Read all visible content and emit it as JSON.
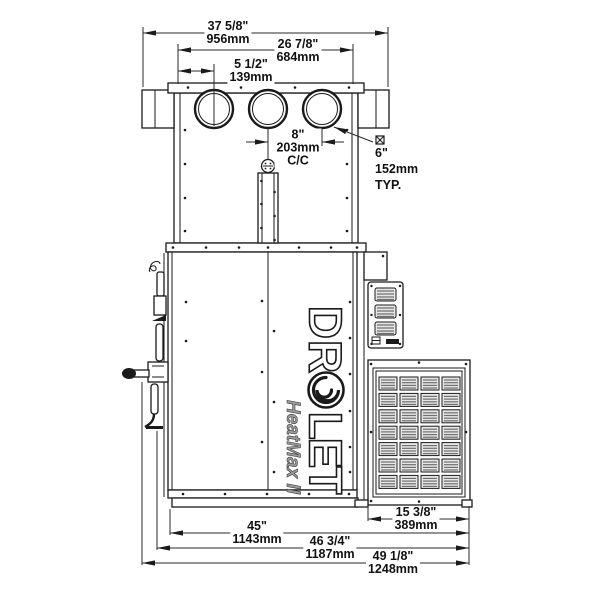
{
  "logo": {
    "brand_top": "DR",
    "brand_bottom": "LET",
    "model": "HeatMax II"
  },
  "dims": {
    "overall_width": {
      "in": "37 5/8\"",
      "mm": "956mm"
    },
    "plenum_width": {
      "in": "26 7/8\"",
      "mm": "684mm"
    },
    "collar_offset": {
      "in": "5 1/2\"",
      "mm": "139mm"
    },
    "collar_spacing": {
      "in": "8\"",
      "mm": "203mm",
      "note": "C/C"
    },
    "collar_diameter": {
      "in": "6\"",
      "mm": "152mm",
      "note": "TYP."
    },
    "grille_width": {
      "in": "15 3/8\"",
      "mm": "389mm"
    },
    "body_width": {
      "in": "45\"",
      "mm": "1143mm"
    },
    "body_with_trim": {
      "in": "46 3/4\"",
      "mm": "1187mm"
    },
    "overall_depth": {
      "in": "49 1/8\"",
      "mm": "1248mm"
    }
  },
  "grille": {
    "rows": 7,
    "cols": 4
  },
  "colors": {
    "line": "#1a1a1a",
    "louver": "#e6e6e6",
    "slat": "#6f6f6f",
    "model_gray": "#9a9a9a"
  }
}
